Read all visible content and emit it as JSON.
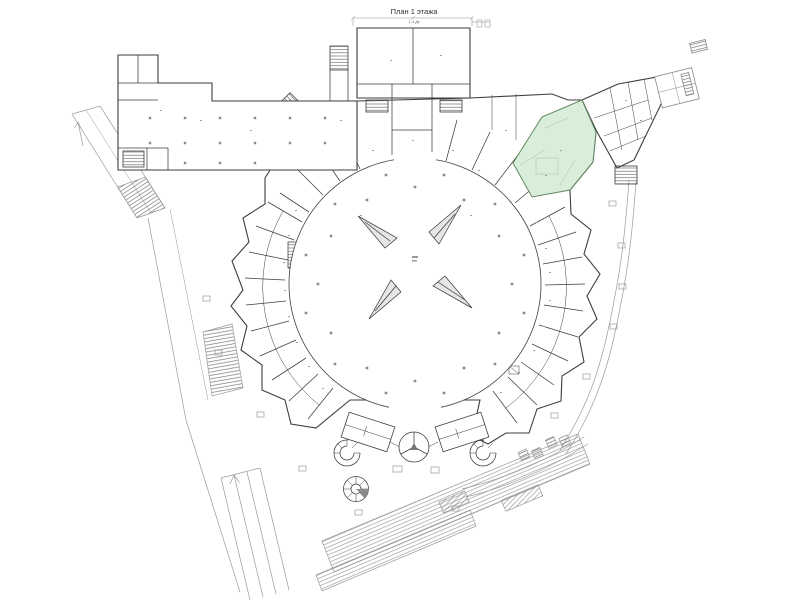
{
  "header": {
    "title": "План 1 этажа",
    "subtitle": "1-4 Дк"
  },
  "colors": {
    "background": "#ffffff",
    "wall": "#3d3d3d",
    "wall_light": "#8a8a8a",
    "site": "#9a9a9a",
    "hatch": "#6f6f6f",
    "highlight_fill": "#d9eeda",
    "highlight_stroke": "#62875f",
    "highlight_detail": "#9cbf9c",
    "column_dot": "#8a8a8a",
    "escalator_fill": "#e6e6e6",
    "noise": "#9b9b9b"
  }
}
